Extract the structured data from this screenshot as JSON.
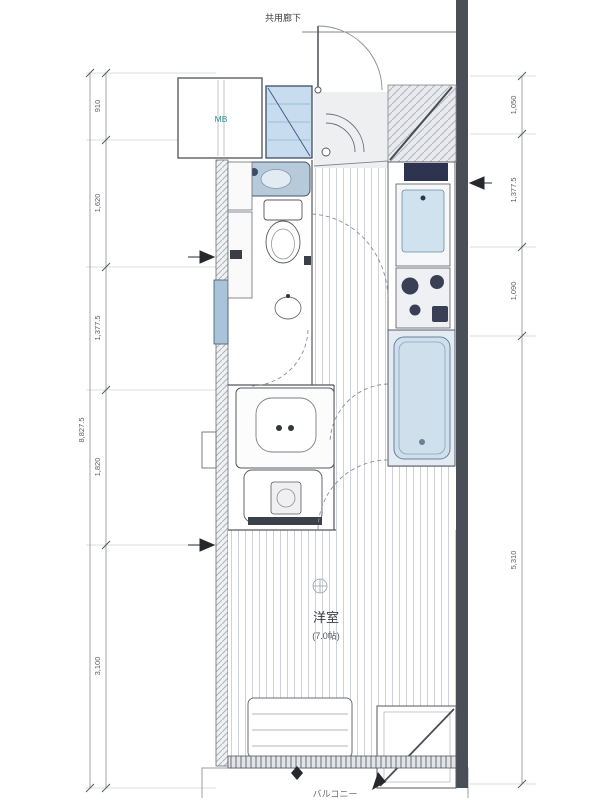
{
  "plan": {
    "corridor_label": "共用廊下",
    "mb_label": "MB",
    "room_label": "洋室",
    "room_size_label": "(7.0帖)",
    "balcony_label": "バルコニー"
  },
  "dimensions": {
    "left_total": "8,827.5",
    "left_segments": [
      "910",
      "1,620",
      "1,377.5",
      "1,820",
      "3,100"
    ],
    "right_segments": [
      "1,050",
      "1,377.5",
      "1,090",
      "5,310"
    ]
  },
  "colors": {
    "line": "#55585f",
    "wall_dark": "#4a4e56",
    "water_blue": "#cfe2ee",
    "fixture_navy": "#2e3450",
    "label_teal": "#2e8f8f",
    "stripe": "#ced1d7",
    "dimension_gray": "#8a8e96"
  }
}
